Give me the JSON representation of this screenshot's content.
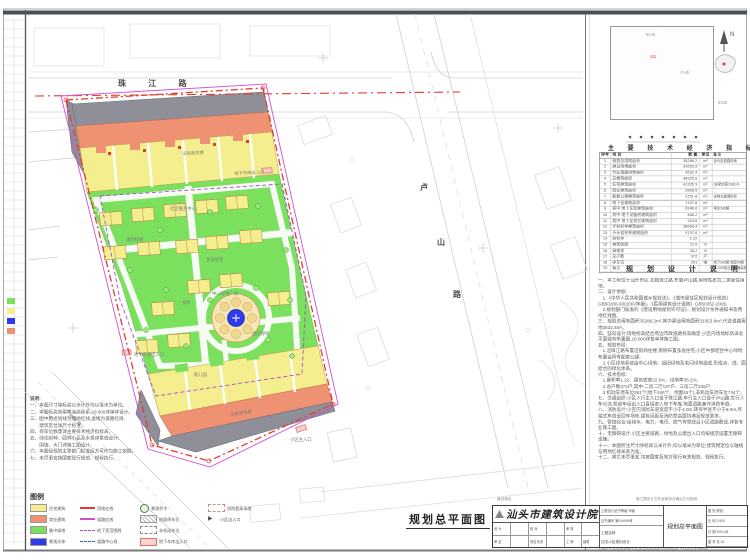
{
  "sheet": {
    "main_title": "规划总平面图",
    "north_letter": "N"
  },
  "roads": {
    "top_label": "珠 江 路",
    "east_chars": [
      {
        "ch": "卢",
        "x": 420,
        "y": 182
      },
      {
        "ch": "山",
        "x": 437,
        "y": 237
      },
      {
        "ch": "路",
        "x": 453,
        "y": 289
      }
    ]
  },
  "minimap": {
    "label_site": "本案",
    "label_road1": "珠江路",
    "label_road2": "卢山路",
    "caption": "区位图"
  },
  "plan_labels": [
    {
      "text": "沿街商住楼",
      "x": 182,
      "y": 150,
      "r": -3
    },
    {
      "text": "地下车库出入口",
      "x": 234,
      "y": 170,
      "r": -3
    },
    {
      "text": "社区服务中心",
      "x": 170,
      "y": 205,
      "r": 0
    },
    {
      "text": "组团绿地",
      "x": 126,
      "y": 236,
      "r": 0
    },
    {
      "text": "多层住宅",
      "x": 206,
      "y": 256,
      "r": 0
    },
    {
      "text": "会所",
      "x": 182,
      "y": 299,
      "r": 0
    },
    {
      "text": "中心绿地广场",
      "x": 212,
      "y": 290,
      "r": 0
    },
    {
      "text": "组团绿地",
      "x": 252,
      "y": 330,
      "r": 0
    },
    {
      "text": "地下车库出入口",
      "x": 134,
      "y": 351,
      "r": 0
    },
    {
      "text": "幼儿园",
      "x": 194,
      "y": 371,
      "r": 0
    },
    {
      "text": "沿街商住楼",
      "x": 230,
      "y": 411,
      "r": -8
    },
    {
      "text": "小区主入口",
      "x": 290,
      "y": 436,
      "r": 0
    },
    {
      "text": "规 划 路",
      "x": 72,
      "y": 412,
      "r": 44
    }
  ],
  "legend": {
    "title": "图例",
    "columns": [
      [
        {
          "sym": "swatch",
          "color": "#F5EE8E",
          "label": "住宅建筑"
        },
        {
          "sym": "swatch",
          "color": "#EF9273",
          "label": "商业建筑"
        },
        {
          "sym": "swatch",
          "color": "#7CE05F",
          "label": "集中绿地"
        },
        {
          "sym": "swatch",
          "color": "#2C3BF0",
          "label": "景观水体"
        }
      ],
      [
        {
          "sym": "line",
          "color": "#E23B30",
          "label": "用地红线"
        },
        {
          "sym": "line",
          "color": "#D24FD2",
          "label": "道路红线"
        },
        {
          "sym": "dash",
          "color": "#A44FD0",
          "label": "地下室范围线"
        },
        {
          "sym": "dash",
          "color": "#4455DD",
          "label": "道路中心线"
        }
      ],
      [
        {
          "sym": "circle",
          "color": "#567d46",
          "label": "景观乔木"
        },
        {
          "sym": "rect-hatch",
          "color": "#888888",
          "label": "地面停车位"
        },
        {
          "sym": "rect-dash",
          "color": "#888888",
          "label": "非机动车位"
        },
        {
          "sym": "rect-pink",
          "color": "#E86A6A",
          "label": "地下车库出入口"
        }
      ],
      [
        {
          "sym": "rect-dash",
          "color": "#D09090",
          "label": "消防登高场地"
        },
        {
          "sym": "arrow",
          "color": "#555555",
          "label": "小区出入口"
        }
      ]
    ]
  },
  "indicators": {
    "title": "主 要 技 术 经 济 指 标",
    "headers": [
      "序号",
      "项  目",
      "数  量",
      "单位",
      "备  注"
    ],
    "rows": [
      [
        "1",
        "规划总用地面积",
        "35286.2",
        "m²",
        "含代征道路用地"
      ],
      [
        "2",
        "建设用地面积",
        "31653.8",
        "m²",
        ""
      ],
      [
        "3",
        "代征道路用地面积",
        "3632.4",
        "m²",
        ""
      ],
      [
        "4",
        "总建筑面积",
        "46325.6",
        "m²",
        ""
      ],
      [
        "5",
        "住宅建筑面积",
        "41205.3",
        "m²",
        "(含架空层2080.4)"
      ],
      [
        "6",
        "商业建筑面积",
        "2868.5",
        "m²",
        ""
      ],
      [
        "7",
        "配套公建建筑面积",
        "2251.8",
        "m²",
        "含物业管理用房"
      ],
      [
        "",
        "",
        "",
        "",
        ""
      ],
      [
        "8",
        "地下室建筑面积",
        "7157.6",
        "m²",
        ""
      ],
      [
        "9",
        "其中 地下车库建筑面积",
        "6346.6",
        "m²",
        "停车346辆"
      ],
      [
        "10",
        "其中 地下设备房建筑面积",
        "486.2",
        "m²",
        ""
      ],
      [
        "11",
        "其中 地下室其它建筑面积",
        "324.8",
        "m²",
        ""
      ],
      [
        "12",
        "计容积率建筑面积",
        "38668.4",
        "m²",
        ""
      ],
      [
        "13",
        "不计容积率建筑面积",
        "9737.6",
        "m²",
        ""
      ],
      [
        "14",
        "容积率",
        "1.22",
        "",
        ""
      ],
      [
        "15",
        "建筑密度",
        "22.6",
        "%",
        ""
      ],
      [
        "16",
        "绿地率",
        "35.2",
        "%",
        ""
      ],
      [
        "17",
        "总户数",
        "372",
        "户",
        ""
      ],
      [
        "18",
        "停车位",
        "391",
        "辆",
        "地下346辆 地面45辆"
      ],
      [
        "19",
        "备注",
        "",
        "",
        "±0.000相当于黄海高程5.25m,本表指标以规划部门核定批准文件为准"
      ]
    ]
  },
  "notes": {
    "title": "规 划 设 计 说 明",
    "lines": [
      "一、本工程位于汕头市区,北临珠江路,东临卢山路,用地性质为二类居住用地。",
      "二、设计依据:",
      "　1.《中华人民共和国城乡规划法》、《城市居住区规划设计规范》GB50180-93(2002年版)、《民用建筑设计通则》GB50352-2005;",
      "　2.规划部门核发的《建设用地规划许可证》、规划设计条件通知书及用地红线图。",
      "三、规划总用地面积35286.2m²,其中建设用地面积31653.8m²,代征道路用地3632.4m²。",
      "四、竖向设计:场地标高结合周边市政道路标高确定,小区内场地标高详总平面竖向布置图,±0.000详各单体施工图。",
      "五、规划布局:",
      "　1.沿珠江路布置沿街商住楼,南侧布置多层住宅,小区中部结合中心绿地布置会所等配套公建;",
      "　2.小区绿地系统由中心绿地、组团绿地及宅间绿地组成,形成点、线、面结合的绿化体系。",
      "六、技术指标:",
      "　1.容积率1.22、建筑密度22.6%、绿地率35.2%;",
      "　2.总户数372户,其中:二房二厅137户、三房二厅235户;",
      "　3.机动车停车位391个(地下346个、地面45个),非机动车停车位744个。",
      "七、交通组织:小区人行主入口设于珠江路,车行主入口设于卢山路;实行人车分流,机动车经出入口直接进入地下车库,地面道路兼作消防车道。",
      "八、消防设计:小区内消防车道宽度不小于4.0m,转弯半径不小于9.0m,尽端式车道设回车场地;建筑间距及消防登高面均满足规范要求。",
      "九、管线综合:给排水、电力、电讯、燃气等管线沿小区道路敷设,详各专业施工图。",
      "十、无障碍设计:小区主要道路、绿地及公建出入口均按规范设置无障碍设施。",
      "十一、本图所注尺寸除标高以米计外,均以毫米为单位;建筑物定位以轴线与用地红线关系为准。",
      "十二、其它未尽事宜,均按国家及地方现行有关规范、规程执行。"
    ]
  },
  "plan_notes": {
    "title": "说明:",
    "lines": [
      "一、本图尺寸除标高以米计外均以毫米为单位。",
      "二、本图标高采用黄海高程系,±0.000详单体设计。",
      "三、图中粗点划线为用地红线,虚线为道路红线,",
      "　　建筑定位详尺寸标注。",
      "四、停车位数量详主要技术经济指标表。",
      "五、绿化树种、园林小品及水景详景观设计;",
      "　　围墙、大门详施工图设计。",
      "六、本图经规划主管部门批准后方可作为施工依据。",
      "七、未尽事宜按国家现行规范、规程执行。"
    ]
  },
  "titleblock": {
    "institute": "汕头市建筑设计院",
    "cert_line1": "工程设计证书等级 甲级",
    "cert_line2": "证书编号 第044006号",
    "client_label": "建设单位",
    "project_label": "工程名称",
    "project_value": "住宅小区规划设计",
    "drawing_value": "规划总平面图",
    "staff": [
      [
        "设 计",
        ""
      ],
      [
        "校 对",
        ""
      ],
      [
        "审 核",
        ""
      ],
      [
        "审 定",
        ""
      ],
      [
        "项目负责",
        ""
      ],
      [
        "工 种",
        "建筑"
      ]
    ],
    "meta": [
      [
        "图 别",
        "规划"
      ],
      [
        "比 例",
        "1:500"
      ],
      [
        "日 期",
        "2004.08"
      ],
      [
        "图 号",
        "总-01"
      ]
    ],
    "ann_left": "建设单位:",
    "ann_right": "施工图设计文件经审查合格后方可使用",
    "ann_below": "本图纸未经本院盖章无效 设计文件版权归本院所有 未经许可不得复制"
  },
  "colors": {
    "yellow": "#F5EE8E",
    "salmon": "#EF9273",
    "green": "#7CE05F",
    "blue": "#2C3BF0",
    "redline": "#E23B30",
    "magenta": "#D24FD2",
    "purple": "#A44FD0",
    "grayband": "#8F8F99"
  }
}
